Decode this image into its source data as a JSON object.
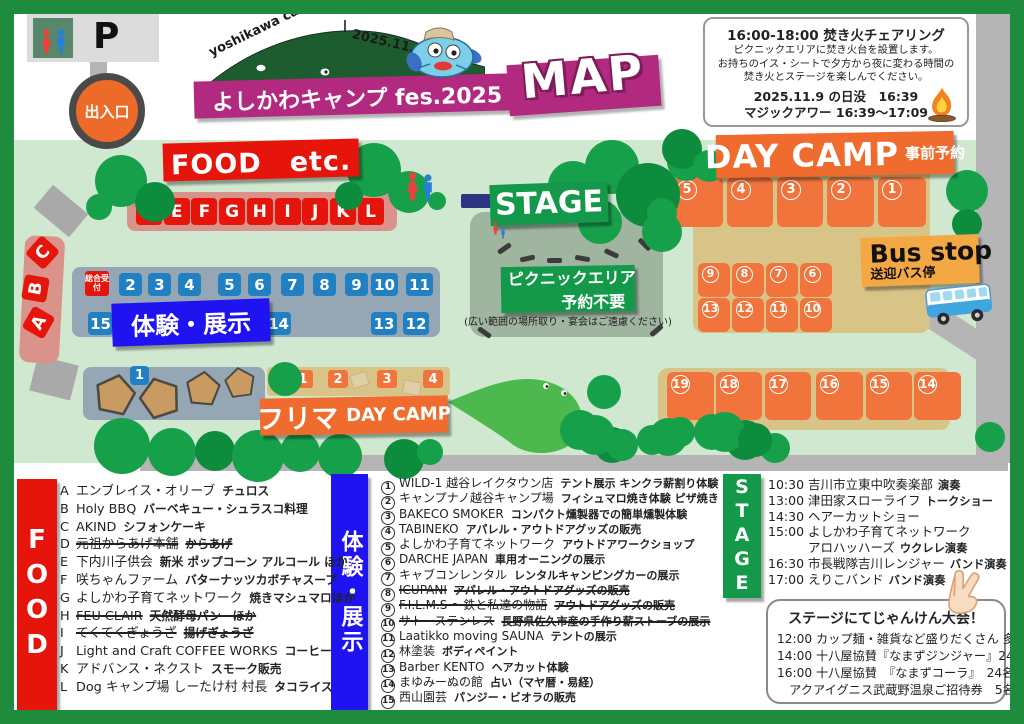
{
  "colors": {
    "frame_green": "#1f8b3c",
    "map_green": "#d0e8d0",
    "tree_green": "#17a04a",
    "banner_red": "#e6150b",
    "banner_blue": "#2013f2",
    "banner_green": "#14994a",
    "banner_orange": "#ef6b2e",
    "banner_magenta": "#b22a80",
    "bus_stop_yellow": "#f3a844",
    "box_orange": "#f0743c",
    "square_blue": "#2080c2",
    "area_tan": "#d9c487",
    "area_blue_gray": "#95a7b4",
    "area_pink": "#d9938b"
  },
  "header": {
    "parking_label": "P",
    "gate_label": "出入口",
    "title": {
      "arc_left": "yoshikawa camp fes.",
      "arc_right": "2025.11.9 sun",
      "banner": "よしかわキャンプ fes.2025",
      "map_label": "MAP"
    },
    "info_box": {
      "title": "16:00-18:00 焚き火チェアリング",
      "body": [
        "ピクニックエリアに焚き火台を設置します。",
        "お持ちのイス・シートで夕方から夜に変わる時間の",
        "焚き火とステージを楽しんでください。"
      ],
      "sunset": "2025.11.9 の日没　16:39",
      "magic_hour": "マジックアワー 16:39～17:09"
    }
  },
  "map_area": {
    "food_banner": "FOOD　etc.",
    "stall_row": [
      "D",
      "E",
      "F",
      "G",
      "H",
      "I",
      "J",
      "K",
      "L"
    ],
    "stall_side": [
      "C",
      "B",
      "A"
    ],
    "reception_label": "総合受付",
    "taiken_banner": "体験・展示",
    "taiken_top_row": [
      "2",
      "3",
      "4",
      "5",
      "6",
      "7",
      "8",
      "9",
      "10",
      "11"
    ],
    "taiken_bottom_row": [
      "15",
      "14",
      "13",
      "12"
    ],
    "stage_banner": "STAGE",
    "picnic": {
      "line1": "ピクニックエリア",
      "line2": "予約不要",
      "note": "(広い範囲の場所取り・宴会はご遠慮ください)"
    },
    "day_camp": {
      "banner": "DAY CAMP",
      "banner_sub": "事前予約",
      "row_top": [
        "5",
        "4",
        "3",
        "2",
        "1"
      ],
      "grid_upper": [
        "9",
        "8",
        "7",
        "6"
      ],
      "grid_lower": [
        "13",
        "12",
        "11",
        "10"
      ],
      "row_bottom": [
        "19",
        "18",
        "17",
        "16",
        "15",
        "14"
      ]
    },
    "bus_stop": {
      "title": "Bus stop",
      "sub": "送迎バス停"
    },
    "flea": {
      "banner": "フリマ",
      "banner_sub": "DAY CAMP",
      "pen_label": "1",
      "spots": [
        "1",
        "2",
        "3",
        "4"
      ]
    }
  },
  "legend": {
    "food": {
      "banner": "FOOD",
      "items": [
        {
          "key": "A",
          "name": "エンブレイス・オリーブ",
          "detail": "チュロス",
          "cancelled": false
        },
        {
          "key": "B",
          "name": "Holy BBQ",
          "detail": "バーベキュー・シュラスコ料理",
          "cancelled": false
        },
        {
          "key": "C",
          "name": "AKIND",
          "detail": "シフォンケーキ",
          "cancelled": false
        },
        {
          "key": "D",
          "name": "元祖からあげ本舗",
          "detail": "からあげ",
          "cancelled": true
        },
        {
          "key": "E",
          "name": "下内川子供会",
          "detail": "新米 ポップコーン アルコール ほか",
          "cancelled": false
        },
        {
          "key": "F",
          "name": "咲ちゃんファーム",
          "detail": "バターナッツカボチャスープ",
          "cancelled": false
        },
        {
          "key": "G",
          "name": "よしかわ子育てネットワーク",
          "detail": "焼きマシュマロほか",
          "cancelled": false
        },
        {
          "key": "H",
          "name": "FEU CLAIR",
          "detail": "天然酵母パン　ほか",
          "cancelled": true
        },
        {
          "key": "I",
          "name": "てくてくぎょうざ",
          "detail": "揚げぎょうざ",
          "cancelled": true
        },
        {
          "key": "J",
          "name": "Light and Craft COFFEE WORKS",
          "detail": "コーヒー",
          "cancelled": false
        },
        {
          "key": "K",
          "name": "アドバンス・ネクスト",
          "detail": "スモーク販売",
          "cancelled": false
        },
        {
          "key": "L",
          "name": "Dog キャンプ場 しーたけ村 村長",
          "detail": "タコライス",
          "cancelled": false
        }
      ]
    },
    "taiken": {
      "banner": "体験・展示",
      "items": [
        {
          "num": "1",
          "name": "WILD-1 越谷レイクタウン店",
          "detail": "テント展示 キンクラ薪割り体験",
          "cancelled": false
        },
        {
          "num": "2",
          "name": "キャンプナノ越谷キャンプ場",
          "detail": "フィシュマロ焼き体験 ピザ焼き",
          "cancelled": false
        },
        {
          "num": "3",
          "name": "BAKECO SMOKER",
          "detail": "コンパクト燻製器での簡単燻製体験",
          "cancelled": false
        },
        {
          "num": "4",
          "name": "TABINEKO",
          "detail": "アパレル・アウトドアグッズの販売",
          "cancelled": false
        },
        {
          "num": "5",
          "name": "よしかわ子育てネットワーク",
          "detail": "アウトドアワークショップ",
          "cancelled": false
        },
        {
          "num": "6",
          "name": "DARCHE JAPAN",
          "detail": "車用オーニングの展示",
          "cancelled": false
        },
        {
          "num": "7",
          "name": "キャブコンレンタル",
          "detail": "レンタルキャンピングカーの展示",
          "cancelled": false
        },
        {
          "num": "8",
          "name": "ICUPANI",
          "detail": "アパレル・アウトドアグッズの販売",
          "cancelled": true
        },
        {
          "num": "9",
          "name": "F.I.L.M.S ～鉄と私達の物語",
          "detail": "アウトドアグッズの販売",
          "cancelled": true
        },
        {
          "num": "10",
          "name": "サトーステンレス",
          "detail": "長野県佐久市産の手作り薪ストーブの展示",
          "cancelled": true
        },
        {
          "num": "11",
          "name": "Laatikko moving SAUNA",
          "detail": "テントの展示",
          "cancelled": false
        },
        {
          "num": "12",
          "name": "林塗装",
          "detail": "ボディペイント",
          "cancelled": false
        },
        {
          "num": "13",
          "name": "Barber KENTO",
          "detail": "ヘアカット体験",
          "cancelled": false
        },
        {
          "num": "14",
          "name": "まゆみーぬの館",
          "detail": "占い（マヤ暦・易経）",
          "cancelled": false
        },
        {
          "num": "15",
          "name": "西山園芸",
          "detail": "パンジー・ビオラの販売",
          "cancelled": false
        }
      ]
    },
    "stage": {
      "banner": "STAGE",
      "items": [
        {
          "time": "10:30",
          "name": "吉川市立東中吹奏楽部",
          "tag": "演奏"
        },
        {
          "time": "13:00",
          "name": "津田家スローライフ",
          "tag": "トークショー"
        },
        {
          "time": "14:30",
          "name": "ヘアーカットショー",
          "tag": ""
        },
        {
          "time": "15:00",
          "name": "よしかわ子育てネットワーク",
          "tag": ""
        },
        {
          "time": "",
          "name": "アロハッハーズ",
          "tag": "ウクレレ演奏"
        },
        {
          "time": "16:30",
          "name": "市長戦隊吉川レンジャー",
          "tag": "バンド演奏"
        },
        {
          "time": "17:00",
          "name": "えりこバンド",
          "tag": "バンド演奏"
        }
      ]
    },
    "janken": {
      "title": "ステージにてじゃんけん大会！",
      "lines": [
        "12:00 カップ麺・雑貨など盛りだくさん 多数",
        "14:00 十八屋協賛『なまずジンジャー』24名",
        "16:00 十八屋協賛　『なまずコーラ』　24名",
        "　アクアイグニス武蔵野温泉ご招待券　5名"
      ]
    }
  }
}
